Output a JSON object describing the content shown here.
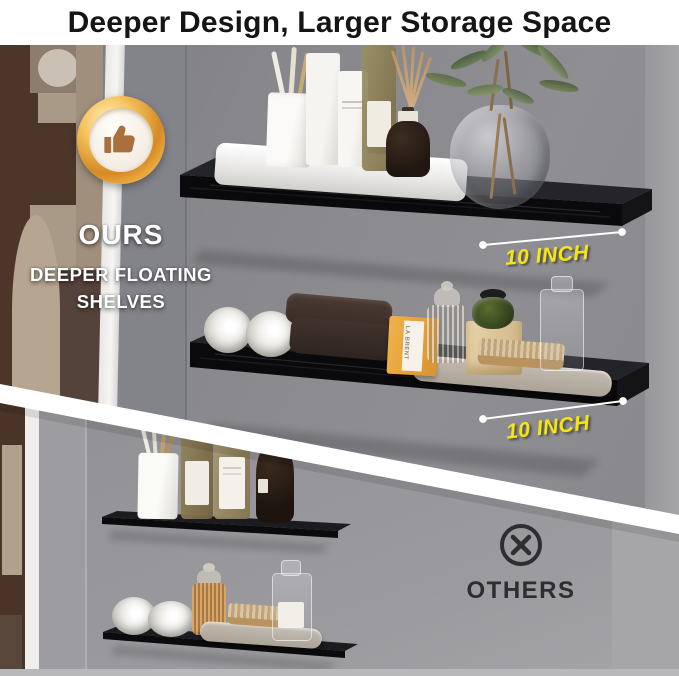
{
  "banner": {
    "title": "Deeper Design, Larger Storage Space"
  },
  "ours": {
    "badge_icon": "thumbs-up-icon",
    "label": "OURS",
    "subtitle_line1": "DEEPER FLOATING",
    "subtitle_line2": "SHELVES",
    "shelf1_depth_label": "10 INCH",
    "shelf2_depth_label": "10 INCH",
    "soap_box_label": "LA BRENT"
  },
  "others": {
    "icon": "x-circle-icon",
    "label": "OTHERS"
  },
  "colors": {
    "accent_yellow": "#f7e512",
    "badge_gold": "#e8a33d",
    "shelf_black": "#0d0d10",
    "ours_wall_gray": "#8a8a8e",
    "others_wall_gray": "#97979b",
    "text_dark": "#2e2e30",
    "banner_text": "#151515"
  }
}
